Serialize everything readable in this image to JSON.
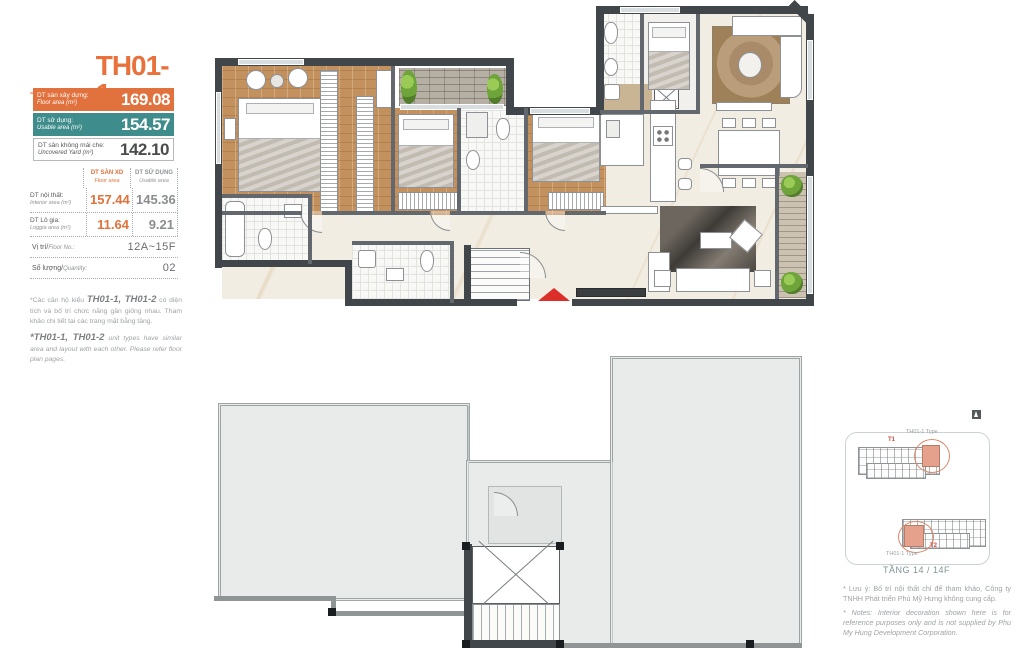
{
  "unit": {
    "type_label": "Tophouse",
    "code": "TH01-1"
  },
  "stats": [
    {
      "label_vi": "DT sàn xây dựng:",
      "label_en": "Floor area (m²)",
      "value": "169.08",
      "color": "#E1713D"
    },
    {
      "label_vi": "DT sử dụng:",
      "label_en": "Usable area (m²)",
      "value": "154.57",
      "color": "#3E8C8B"
    },
    {
      "label_vi": "DT sân không mái che:",
      "label_en": "Uncovered Yard (m²)",
      "value": "142.10",
      "color": "#FFFFFF"
    }
  ],
  "area_table": {
    "columns": [
      {
        "vi": "DT SÀN XD",
        "en": "Floor area"
      },
      {
        "vi": "DT SỬ DỤNG",
        "en": "Usable area"
      }
    ],
    "rows": [
      {
        "label_vi": "DT nội thất:",
        "label_en": "Interior area (m²)",
        "floor_area": "157.44",
        "usable_area": "145.36"
      },
      {
        "label_vi": "DT Lô gia:",
        "label_en": "Loggia area (m²)",
        "floor_area": "11.64",
        "usable_area": "9.21"
      }
    ],
    "floor_row": {
      "label_vi": "Vị trí/",
      "label_en": "Floor No.:",
      "value": "12A~15F"
    },
    "quantity_row": {
      "label_vi": "Số lượng/",
      "label_en": "Quantity:",
      "value": "02"
    }
  },
  "notes_left": {
    "vi_prefix": "*Các căn hộ kiểu ",
    "vi_codes": "TH01-1, TH01-2",
    "vi_rest": " có diện tích và bố trí chức năng gần giống nhau. Tham khảo chi tiết tại các trang mặt bằng tầng.",
    "en_codes": "*TH01-1, TH01-2",
    "en_rest": " unit types have similar area and layout with each other. Please refer floor plan pages."
  },
  "site_map": {
    "tower_top_label": "T1",
    "tower_top_unit": "TH01-1 Type",
    "tower_bottom_label": "T2",
    "tower_bottom_unit": "TH01-1 Type",
    "caption": "TẦNG 14 / 14F",
    "note_vi": "* Lưu ý: Bố trí nội thất chỉ để tham khảo, Công ty TNHH Phát triển Phú Mỹ Hưng không cung cấp.",
    "note_en": "* Notes: Interior decoration shown here is for reference purposes only and is not supplied by Phu My Hung Development Corporation.",
    "accent_red": "#D04A36",
    "highlight_salmon": "#E5A18C"
  }
}
